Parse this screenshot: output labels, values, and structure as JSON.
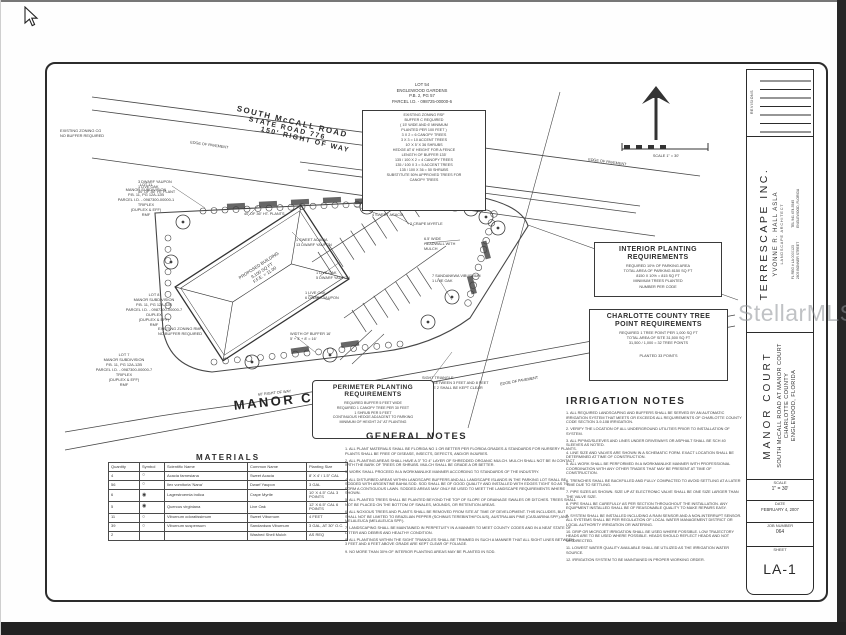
{
  "watermark": "StellarMLS",
  "north": {
    "scale_caption": "SCALE 1\" = 30'"
  },
  "roads": {
    "mccall_line1": "SOUTH McCALL ROAD",
    "mccall_line2": "STATE ROAD 776",
    "mccall_line3": "150' RIGHT OF WAY",
    "grass_median": "GRASS MEDIAN",
    "edge_of_pavement": "EDGE OF PAVEMENT",
    "manor_court": "MANOR COURT",
    "manor_row": "60' RIGHT OF WAY"
  },
  "plan": {
    "building": "PROPOSED BUILDING\n9,100 SQ FT\nF.F.E. = 11.00",
    "callouts": [
      "1 SWEET ACACIA\n13 DWARF YAUPON",
      "12 SWEET VIBURNUM\n4 SWEET ACACIA",
      "2 CRAPE MYRTLE",
      "6.5' WIDE\nHEADWALL WITH\nMULCH",
      "7 SANDANKWA VIBURNUM\n1 LIVE OAK",
      "1 LIVE OAK\n5 DWARF YAUPON",
      "1 LIVE OAK\n6 DWARF YAUPON",
      "40' OF 36\" HT. PLANTS",
      "3 DWARF YAUPON\n1 LIVE OAK\n50' OF 36\" HT PLANT",
      "WIDTH OF BUFFER 16'\n5' + 3' + 8' = 16'",
      "SIGHT TRIANGLE\n(NTS) BETWEEN 3 FEET AND 8 FEET\nOF THE 2 SHALL BE KEPT CLEAR"
    ]
  },
  "lots": {
    "lot54_header": "LOT 54\nENGLEWOOD GARDENS\nP.B. 2, PG 57\nPARCEL I.D. - 098725-00000-6",
    "lot54_buffer": [
      "EXISTING ZONING RSF",
      "BUFFER C REQUIRED",
      "( 15' WIDE AND 6' MINIMUM",
      "PLANTED PER 100 FEET )",
      "3 X 2 = 6 CANOPY TREES",
      "3 X 3 = 10 ACCENT TREES",
      "10' X 5' X 36 SHRUBS",
      "HEDGE AT 6' HEIGHT FOR A FENCE",
      "LENGTH OF BUFFER 135'",
      "135 / 100 X 2 = 4 CANOPY TREES",
      "135 / 100 X 3 = 5 ACCENT TREES",
      "135 / 100 X 36 = 50 SHRUBS",
      "SUBSTITUTE 50% APPROVED TREES FOR",
      "CANOPY TREES"
    ],
    "lot11": "LOT 11\nMANOR SUBDIVISION\nP.B. 11, PG 12A-12B\nPARCEL I.D. - 0987300-00000-1\nTRIPLEX\n(DUPLEX & EFF)\nRMF",
    "lot8": "LOT 8\nMANOR SUBDIVISION\nP.B. 11, PG 12A-12B\nPARCEL I.D. - 0987300-00000-7\nDUPLEX\n(DUPLEX & EFF)\nRMF",
    "lot7": "LOT 7\nMANOR SUBDIVISION\nP.B. 11, PG 12A-12B\nPARCEL I.D. - 0987300-00000-7\nTRIPLEX\n(DUPLEX & EFF)\nRMF",
    "zoning_top_left": "EXISTING ZONING CG\nNO BUFFER REQUIRED",
    "zoning_lot8": "EXISTING ZONING RMF\nNO BUFFER REQUIRED"
  },
  "boxes": {
    "interior": {
      "title": "INTERIOR PLANTING\nREQUIREMENTS",
      "lines": [
        "REQUIRED 10% OF PARKING AREA",
        "TOTAL AREA OF PARKING 8150 SQ FT",
        "8150 X 10% = 815 SQ FT",
        "MINIMUM TREES PLANTED",
        "NUMBER PER CODE"
      ]
    },
    "tree_points": {
      "title": "CHARLOTTE COUNTY TREE\nPOINT REQUIREMENTS",
      "lines": [
        "REQUIRED 1 TREE POINT PER 1,000 SQ FT",
        "TOTAL AREA OF SITE 31,500 SQ FT",
        "31,500 / 1,000 = 32 TREE POINTS"
      ],
      "footer": "PLANTED 33 POINTS"
    },
    "perimeter": {
      "title": "PERIMETER PLANTING\nREQUIREMENTS",
      "lines": [
        "REQUIRED BUFFER 5 FEET WIDE",
        "REQUIRED 1 CANOPY TREE PER 30 FEET",
        "1 SHRUB PER 5 FEET",
        "CONTINUOUS HEDGE ADJACENT TO PARKING",
        "MINIMUM OF HEIGHT 24\" AT PLANTING"
      ]
    }
  },
  "general_notes": {
    "title": "GENERAL NOTES",
    "items": [
      "1.  ALL PLANT MATERIALS SHALL BE FLORIDA NO 1 OR BETTER PER FLORIDA GRADES & STANDARDS FOR NURSERY PLANTS. PLANTS SHALL BE FREE OF DISEASE, INSECTS, DEFECTS, AND/OR INJURIES.",
      "2.  ALL PLANTING AREAS SHALL HAVE A 3\" TO 4\" LAYER OF SHREDDED ORGANIC MULCH. MULCH SHALL NOT BE IN CONTACT WITH THE BARK OF TREES OR SHRUBS. MULCH SHALL BE GRADE A OR BETTER.",
      "3.  WORK SHALL PROCEED IN A WORKMANLIKE MANNER ACCORDING TO STANDARDS OF THE INDUSTRY.",
      "4.  ALL DISTURBED AREAS WITHIN LANDSCAPE BUFFERS AND ALL LANDSCAPE ISLANDS IN THE PARKING LOT SHALL BE SODDED WITH ARGENTINE BAHIA SOD. SOD SHALL BE OF GOOD QUALITY AND INSTALLED WITH EDGES TIGHT SO AS TO FORM A CONTIGUOUS LAWN. SODDED AREAS MAY ONLY BE USED TO MEET THE LANDSCAPE REQUIREMENTS WHERE SHOWN.",
      "5.  ALL PLANTED TREES SHALL BE PLANTED BEYOND THE TOP OF SLOPE OF DRAINAGE SWALES OR DITCHES. TREES SHALL NOT BE PLACED ON THE BOTTOM OF SWALES, MOUNDS, OR RETENTION AREAS.",
      "6.  ALL NOXIOUS TREES AND PLANTS SHALL BE REMOVED FROM SITE AT TIME OF DEVELOPMENT. THIS INCLUDES, BUT SHALL NOT BE LIMITED TO BRAZILIAN PEPPER (SCHINUS TEREBINTHIFOLIUS), AUSTRALIAN PINE (CASUARINA SPP.) AND MELALEUCA (MELALEUCA SPP.).",
      "7.  LANDSCAPING SHALL BE MAINTAINED IN PERPETUITY IN A MANNER TO MEET COUNTY CODES AND IN A NEAT STATE OF LITTER AND DEBRIS AND HEALTHY CONDITION.",
      "8.  ALL PLANTINGS WITHIN THE SIGHT TRIANGLES SHALL BE TRIMMED IN SUCH A MANNER THAT ALL SIGHT LINES BETWEEN 3 FEET AND 8 FEET ABOVE GRADE ARE KEPT CLEAR OF FOLIAGE.",
      "9.  NO MORE THAN 30% OF INTERIOR PLANTING AREAS MAY BE PLANTED IN SOD."
    ]
  },
  "irrigation_notes": {
    "title": "IRRIGATION NOTES",
    "items": [
      "1.  ALL REQUIRED LANDSCAPING AND BUFFERS SHALL BE SERVED BY AN AUTOMATIC IRRIGATION SYSTEM THAT MEETS OR EXCEEDS ALL REQUIREMENTS OF CHARLOTTE COUNTY CODE SECTION 3-9-108 IRRIGATION.",
      "2.  VERIFY THE LOCATION OF ALL UNDERGROUND UTILITIES PRIOR TO INSTALLATION OF SYSTEM.",
      "3.  ALL PIPING/SLEEVES AND LINES UNDER DRIVEWAYS OR ASPHALT SHALL BE SCH 40 SLEEVES AS NOTED.",
      "4.  LINE SIZE AND VALVES ARE SHOWN IN A SCHEMATIC FORM. EXACT LOCATION SHALL BE DETERMINED AT TIME OF CONSTRUCTION.",
      "5.  ALL WORK SHALL BE PERFORMED IN A WORKMANLIKE MANNER WITH PROFESSIONAL COORDINATION WITH ANY OTHER TRADES THAT MAY BE PRESENT AT TIME OF CONSTRUCTION.",
      "6.  TRENCHES SHALL BE BACKFILLED AND FULLY COMPACTED TO AVOID SETTLING AT A LATER TIME DUE TO SETTLING.",
      "7.  PIPE SIZES AS SHOWN. SIZE UP AT ELECTRONIC VALVE SHALL BE ONE SIZE LARGER THAN THE VALVE SIZE.",
      "8.  PIPE SHALL BE CAREFULLY AS PER SECTION THROUGHOUT THE INSTALLATION. ANY EQUIPMENT INSTALLED SHALL BE OF REASONABLE QUALITY TO MAKE REPAIRS EASY.",
      "9.  SYSTEM SHALL BE INSTALLED INCLUDING A RAIN SENSOR AND A NON-INTERRUPT SENSOR. ALL SYSTEMS SHALL BE PER REGULATION OF LOCAL WATER MANAGEMENT DISTRICT OR LOCAL AUTHORITY IRRIGATION OR WATERING.",
      "10.  DRIP OR MICROJET IRRIGATION SHALL BE USED WHERE POSSIBLE. LOW TRAJECTORY HEADS ARE TO BE USED WHERE POSSIBLE. HEADS SHOULD REFLECT HEADS AND NOT MISDIRECTED.",
      "11.  LOWEST WATER QUALITY AVAILABLE SHALL BE UTILIZED AS THE IRRIGATION WATER SOURCE.",
      "12.  IRRIGATION SYSTEM TO BE MAINTAINED IN PROPER WORKING ORDER."
    ]
  },
  "materials": {
    "title": "MATERIALS",
    "headers": [
      "Quantity",
      "Symbol",
      "Scientific Name",
      "Common Name",
      "Planting Size"
    ],
    "rows": [
      [
        "4",
        "○",
        "Acacia farnesiana",
        "Sweet Acacia",
        "8' X 4' / 1.5\" CAL"
      ],
      [
        "56",
        "○",
        "Ilex vomitoria 'Nana'",
        "Dwarf Yaupon",
        "3 GAL"
      ],
      [
        "6",
        "◉",
        "Lagerstroemia indica",
        "Crape Myrtle",
        "10' X 4.5\" CAL  3 POINTS"
      ],
      [
        "5",
        "◉",
        "Quercus virginiana",
        "Live Oak",
        "12' X 6.5\" CAL  6 POINTS"
      ],
      [
        "11",
        "○",
        "Viburnum odoratissimum",
        "Sweet Viburnum",
        "4 FEET"
      ],
      [
        "39",
        "○",
        "Viburnum suspensum",
        "Sandankwa Viburnum",
        "3 GAL, AT 30\" O.C."
      ],
      [
        "2",
        "",
        "",
        "Washed Shell Mulch",
        "AS REQ"
      ]
    ]
  },
  "titleblock": {
    "revisions": "REVISIONS",
    "firm_name": "TERRESCAPE  INC.",
    "firm_principal": "YVONNE R. HALL  ASLA",
    "firm_role": "LANDSCAPE ARCHITECT",
    "firm_addr_left": "FL REG # LA 0000123\n2805 BONNER STREET",
    "firm_addr_right": "TEL 941 474-5545\nENGLEWOOD, FLORIDA",
    "project_name": "MANOR COURT",
    "project_line1": "SOUTH McCALL ROAD AT MANOR COURT",
    "project_line2": "CHARLOTTE COUNTY",
    "project_line3": "ENGLEWOOD, FLORIDA",
    "scale_label": "SCALE",
    "scale_value": "1\" = 30'",
    "date_label": "DATE",
    "date_value": "FEBRUARY 4, 2007",
    "job_label": "JOB NUMBER",
    "job_value": "064",
    "sheet_label": "SHEET",
    "sheet_value": "LA-1"
  }
}
